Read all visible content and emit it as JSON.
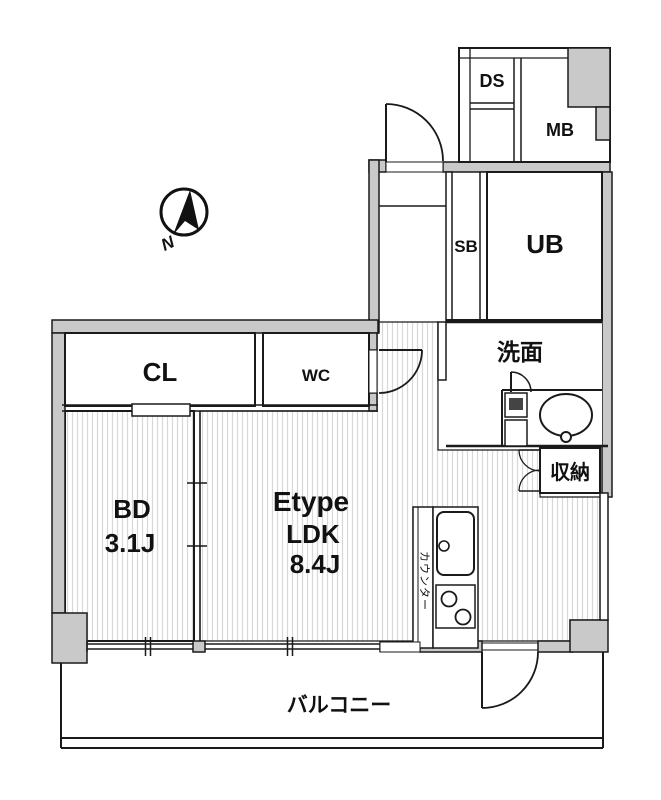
{
  "plan": {
    "type_label": "Etype",
    "labels": {
      "ds": "DS",
      "mb": "MB",
      "sb": "SB",
      "ub": "UB",
      "washroom": "洗面",
      "storage": "収納",
      "closet": "CL",
      "toilet": "WC",
      "bedroom": "BD",
      "bedroom_size": "3.1J",
      "ldk": "LDK",
      "ldk_size": "8.4J",
      "counter": "カウンター",
      "balcony": "バルコニー",
      "north": "N"
    },
    "colors": {
      "wall_fill": "#c9c9c9",
      "line": "#1a1a1a",
      "hatch": "#d8d8d8",
      "background": "#ffffff",
      "washer_box": "#444444"
    }
  }
}
